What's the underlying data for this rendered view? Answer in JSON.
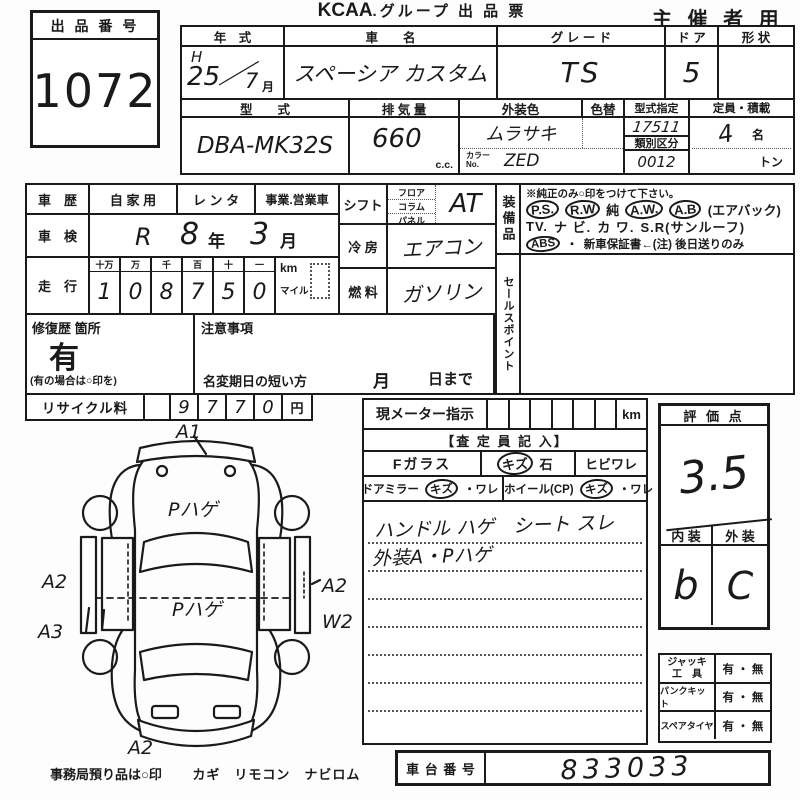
{
  "colors": {
    "ink": "#1a1a1a",
    "paper": "#fdfdfd"
  },
  "header": {
    "lot_label": "出 品 番 号",
    "lot_number": "1072",
    "title_logo": "KCAA",
    "title_rest": ".グループ 出 品 票",
    "audience": "主 催 者 用"
  },
  "top_table": {
    "year_label": "年　式",
    "year_era": "H",
    "year_value": "25",
    "year_slash": "／",
    "year_month": "7",
    "month_suffix": "月",
    "name_label": "車　　名",
    "name_value": "スペーシア カスタム",
    "grade_label": "グ レ ー ド",
    "grade_value": "TS",
    "door_label": "ド ア",
    "door_value": "5",
    "shape_label": "形 状",
    "model_label": "型　　式",
    "model_value": "DBA-MK32S",
    "disp_label": "排 気 量",
    "disp_value": "660",
    "disp_unit": "c.c.",
    "color_label": "外装色",
    "color_value": "ムラサキ",
    "color_change_label": "色替",
    "color_no_label": "カラー\nNo.",
    "color_no_value": "ZED",
    "type_desig_label": "型式指定",
    "type_desig_value": "17511",
    "class_label": "類別区分",
    "class_value": "0012",
    "capacity_label": "定員・積載",
    "capacity_value": "4",
    "capacity_unit": "名",
    "ton_label": "トン"
  },
  "left_table": {
    "history_label": "車　歴",
    "usage_options": [
      "自 家 用",
      "レ ン タ",
      "事業.営業車"
    ],
    "inspection_label": "車　検",
    "inspection_era": "R",
    "inspection_year": "8",
    "inspection_year_suffix": "年",
    "inspection_month": "3",
    "inspection_month_suffix": "月",
    "mileage_label": "走　行",
    "mileage_headers": [
      "十万",
      "万",
      "千",
      "百",
      "十",
      "一"
    ],
    "mileage_digits": [
      "1",
      "0",
      "8",
      "7",
      "5",
      "0"
    ],
    "unit_km": "km",
    "unit_mile": "マイル",
    "repair_label": "修復歴 箇所",
    "repair_value": "有",
    "repair_note": "(有の場合は○印を)",
    "caution_label": "注意事項",
    "name_change_label": "名変期日の短い方",
    "name_change_month": "月",
    "name_change_day": "日まで",
    "recycle_label": "リサイクル料",
    "recycle_digits": [
      "9",
      "7",
      "7",
      "0"
    ],
    "recycle_unit": "円"
  },
  "spec_col": {
    "shift_label": "シフト",
    "shift_types": [
      "フロア",
      "コラム",
      "パネル"
    ],
    "shift_value": "AT",
    "ac_label": "冷 房",
    "ac_value": "エアコン",
    "fuel_label": "燃 料",
    "fuel_value": "ガソリン"
  },
  "equipment": {
    "strip_label": "装備品",
    "note": "※純正のみ○印をつけて下さい。",
    "line1": [
      {
        "t": "P.S.",
        "c": true
      },
      {
        "t": "R.W",
        "c": true
      },
      {
        "t": "純",
        "c": false
      },
      {
        "t": "A.W.",
        "c": true
      },
      {
        "t": "A.B",
        "c": true
      },
      {
        "t": "(エアバック)",
        "c": false
      }
    ],
    "line2": [
      {
        "t": "TV.",
        "c": false
      },
      {
        "t": "ナ ビ.",
        "c": false
      },
      {
        "t": "カ ワ.",
        "c": false
      },
      {
        "t": "S.R(サンルーフ)",
        "c": false
      }
    ],
    "line3": [
      {
        "t": "ABS",
        "c": true
      },
      {
        "t": "・",
        "c": false
      },
      {
        "t": "新車保証書←(注) 後日送りのみ",
        "c": false
      }
    ],
    "sales_strip_label": "セールスポイント"
  },
  "diagram": {
    "front": "A1",
    "hood": "Pハゲ",
    "roof": "Pハゲ",
    "left_mid": "A2",
    "left_low": "A3",
    "right_mid": "A2",
    "right_low": "W2",
    "rear": "A2"
  },
  "assessor": {
    "meter_label": "現メーター指示",
    "meter_unit": "km",
    "section_title": "【査 定 員 記 入】",
    "fglass_label": "Fガラス",
    "fglass_tokens": [
      {
        "t": "キズ",
        "c": true
      },
      {
        "t": "石",
        "c": false
      }
    ],
    "fglass_crack": "ヒビワレ",
    "mirror_tokens": [
      {
        "t": "ドアミラー",
        "c": false
      },
      {
        "t": "キズ",
        "c": true
      },
      {
        "t": "・ワレ",
        "c": false
      }
    ],
    "wheel_tokens": [
      {
        "t": "ホイール(CP)",
        "c": false
      },
      {
        "t": "キズ",
        "c": true
      },
      {
        "t": "・ワレ",
        "c": false
      }
    ],
    "notes_line1": "ハンドル ハゲ　シート スレ",
    "notes_line2": "外装A・Pハゲ"
  },
  "rating": {
    "title": "評 価 点",
    "score": "3.5",
    "interior_label": "内 装",
    "interior_value": "b",
    "exterior_label": "外 装",
    "exterior_value": "C"
  },
  "tools": {
    "rows": [
      {
        "label": "ジャッキ\n工　具",
        "value": "有 ・ 無"
      },
      {
        "label": "パンクキット",
        "value": "有 ・ 無"
      },
      {
        "label": "スペアタイヤ",
        "value": "有 ・ 無"
      }
    ]
  },
  "footer": {
    "chassis_label": "車 台 番 号",
    "chassis_value": "833033",
    "note": "事務局預り品は○印",
    "note_items": "カギ　リモコン　ナビロム"
  }
}
